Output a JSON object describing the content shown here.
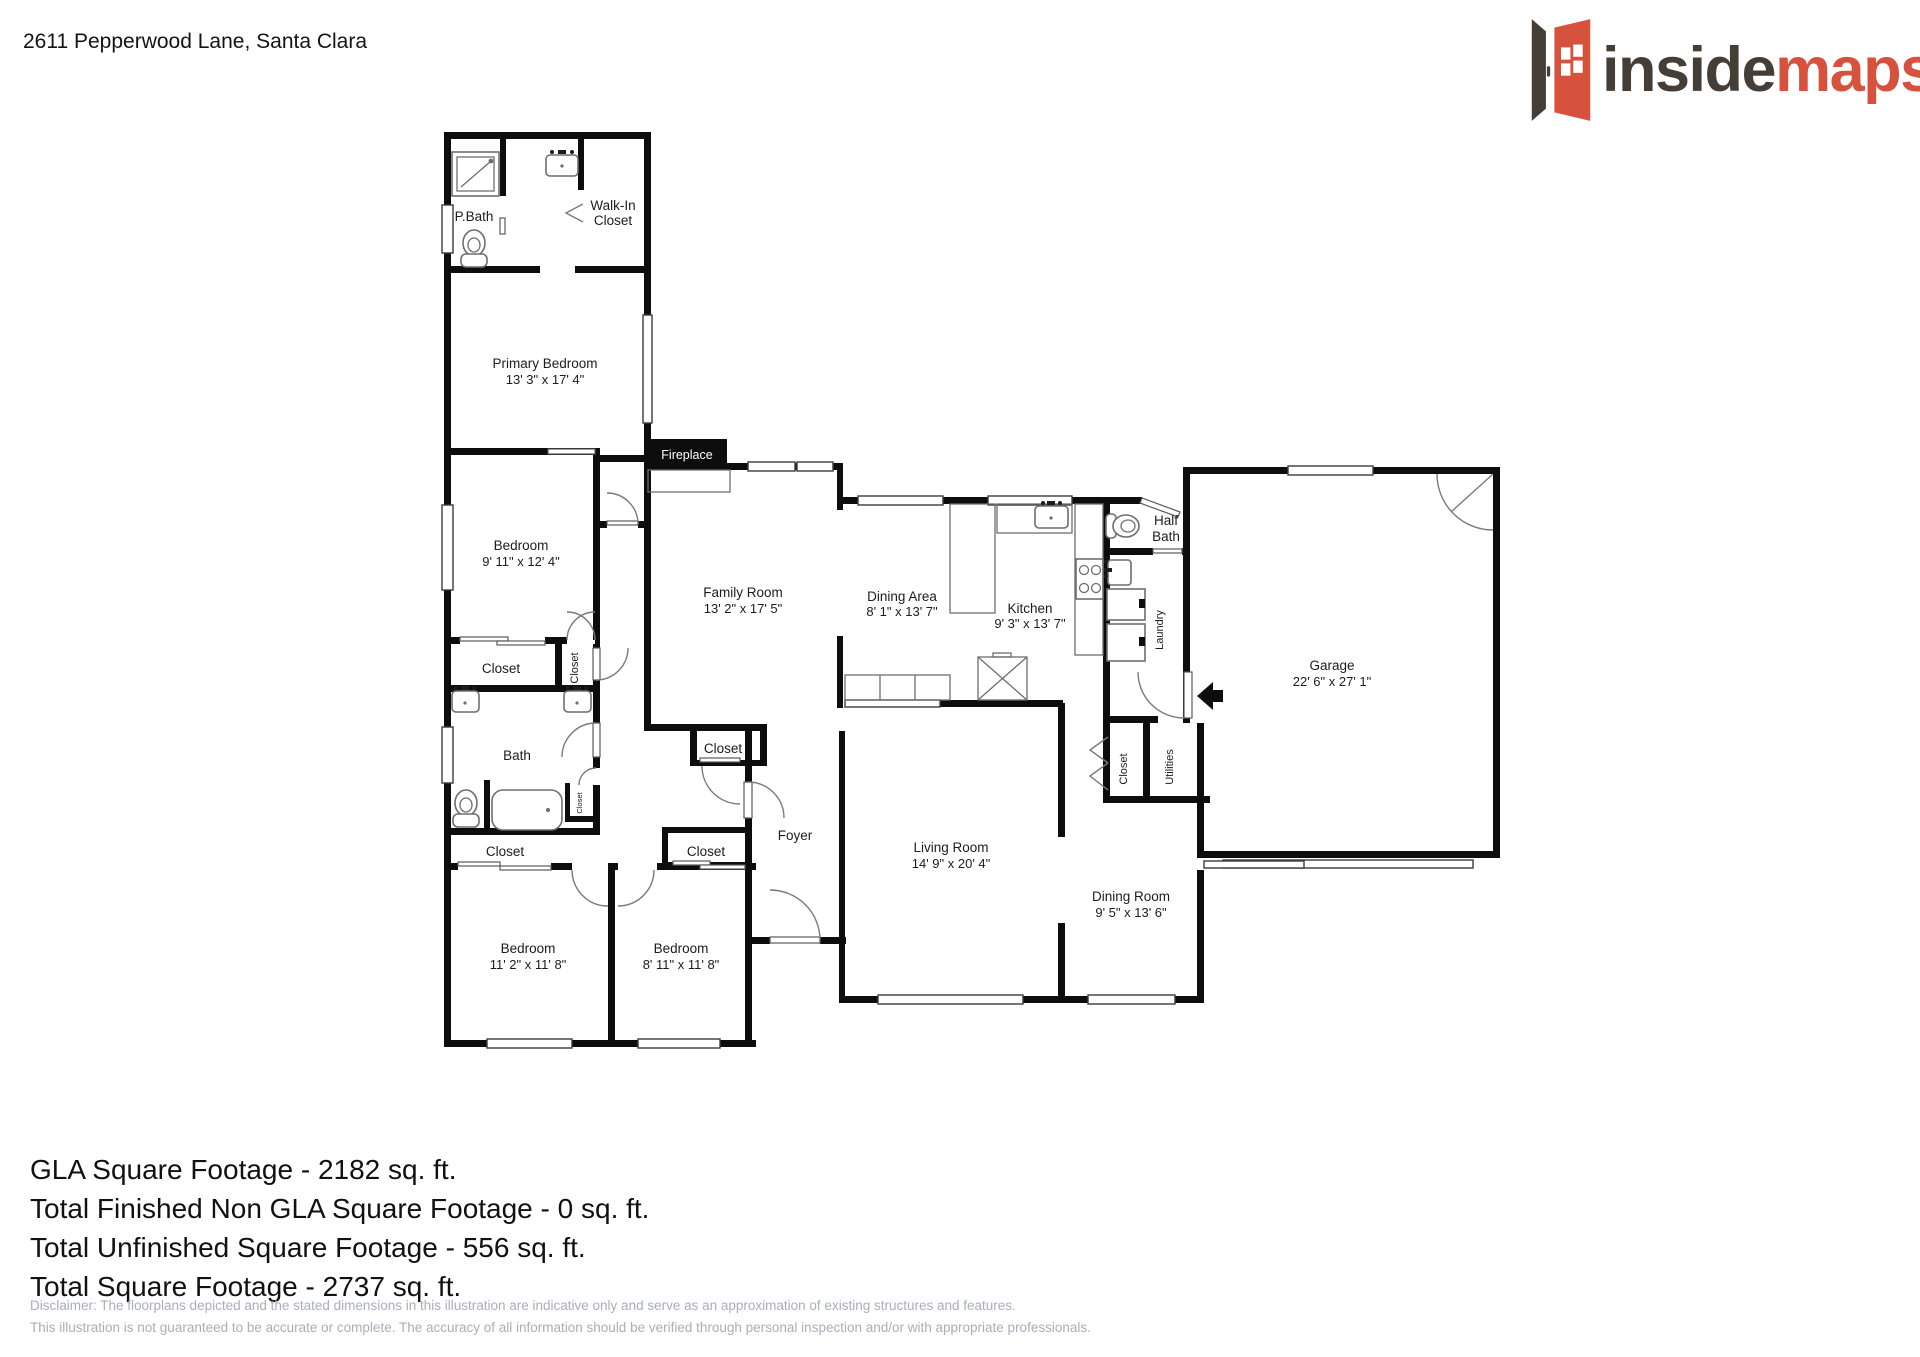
{
  "header": {
    "address": "2611 Pepperwood Lane, Santa Clara"
  },
  "logo": {
    "text_dark": "inside",
    "text_accent": "maps",
    "accent_color": "#d6523c",
    "dark_color": "#453e37"
  },
  "plan": {
    "rooms": {
      "pbath": {
        "name": "P.Bath"
      },
      "walkin": {
        "line1": "Walk-In",
        "line2": "Closet"
      },
      "primary": {
        "name": "Primary Bedroom",
        "dims": "13' 3\" x 17' 4\""
      },
      "bedroom_mid": {
        "name": "Bedroom",
        "dims": "9' 11\" x 12' 4\""
      },
      "family": {
        "name": "Family Room",
        "dims": "13' 2\" x 17' 5\""
      },
      "dining_area": {
        "name": "Dining Area",
        "dims": "8' 1\" x 13' 7\""
      },
      "kitchen": {
        "name": "Kitchen",
        "dims": "9' 3\" x 13' 7\""
      },
      "half_bath": {
        "line1": "Half",
        "line2": "Bath"
      },
      "laundry": {
        "name": "Laundry"
      },
      "garage": {
        "name": "Garage",
        "dims": "22' 6\" x 27' 1\""
      },
      "living": {
        "name": "Living Room",
        "dims": "14' 9\" x 20' 4\""
      },
      "dining_room": {
        "name": "Dining Room",
        "dims": "9' 5\" x 13' 6\""
      },
      "bedroom_sw": {
        "name": "Bedroom",
        "dims": "11' 2\" x 11' 8\""
      },
      "bedroom_s": {
        "name": "Bedroom",
        "dims": "8' 11\" x 11' 8\""
      },
      "bath": {
        "name": "Bath"
      },
      "foyer": {
        "name": "Foyer"
      },
      "utilities": {
        "name": "Utilities"
      },
      "fireplace": {
        "name": "Fireplace"
      },
      "closet": {
        "name": "Closet"
      }
    }
  },
  "summary": {
    "line1": "GLA Square Footage - 2182 sq. ft.",
    "line2": "Total Finished Non GLA Square Footage - 0 sq. ft.",
    "line3": "Total Unfinished Square Footage - 556 sq. ft.",
    "line4": "Total Square Footage - 2737 sq. ft."
  },
  "disclaimer": {
    "line1": "Disclaimer: The floorplans depicted and the stated dimensions in this illustration are indicative only and serve as an approximation of existing structures and features.",
    "line2": "This illustration is not guaranteed to be accurate or complete. The accuracy of all information should be verified through personal inspection and/or with appropriate professionals."
  }
}
